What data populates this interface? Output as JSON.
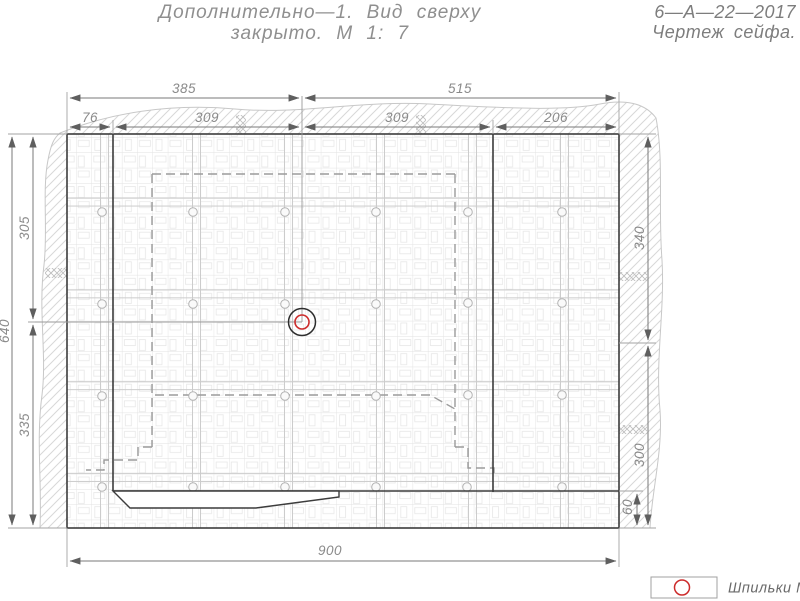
{
  "title": {
    "line1": "Дополнительно—1. Вид сверху",
    "line2": "закрыто. М 1: 7"
  },
  "doc": {
    "number": "6—А—22—2017",
    "name": "Чертеж сейфа."
  },
  "dims": {
    "top_total_left": "385",
    "top_total_right": "515",
    "top_seg1": "76",
    "top_seg2": "309",
    "top_seg3": "309",
    "top_seg4": "206",
    "left_total": "640",
    "left_upper": "305",
    "left_lower": "335",
    "right_upper": "340",
    "right_lower": "300",
    "right_small": "60",
    "bottom_total": "900"
  },
  "legend": {
    "label": "Шпильки М16",
    "marker_color": "#cc2b2b"
  },
  "colors": {
    "outline_dark": "#3c3c3c",
    "dimension_gray": "#8a8a8a",
    "stud_red": "#cc2b2b",
    "hatch_gray": "#d8d8d8"
  }
}
